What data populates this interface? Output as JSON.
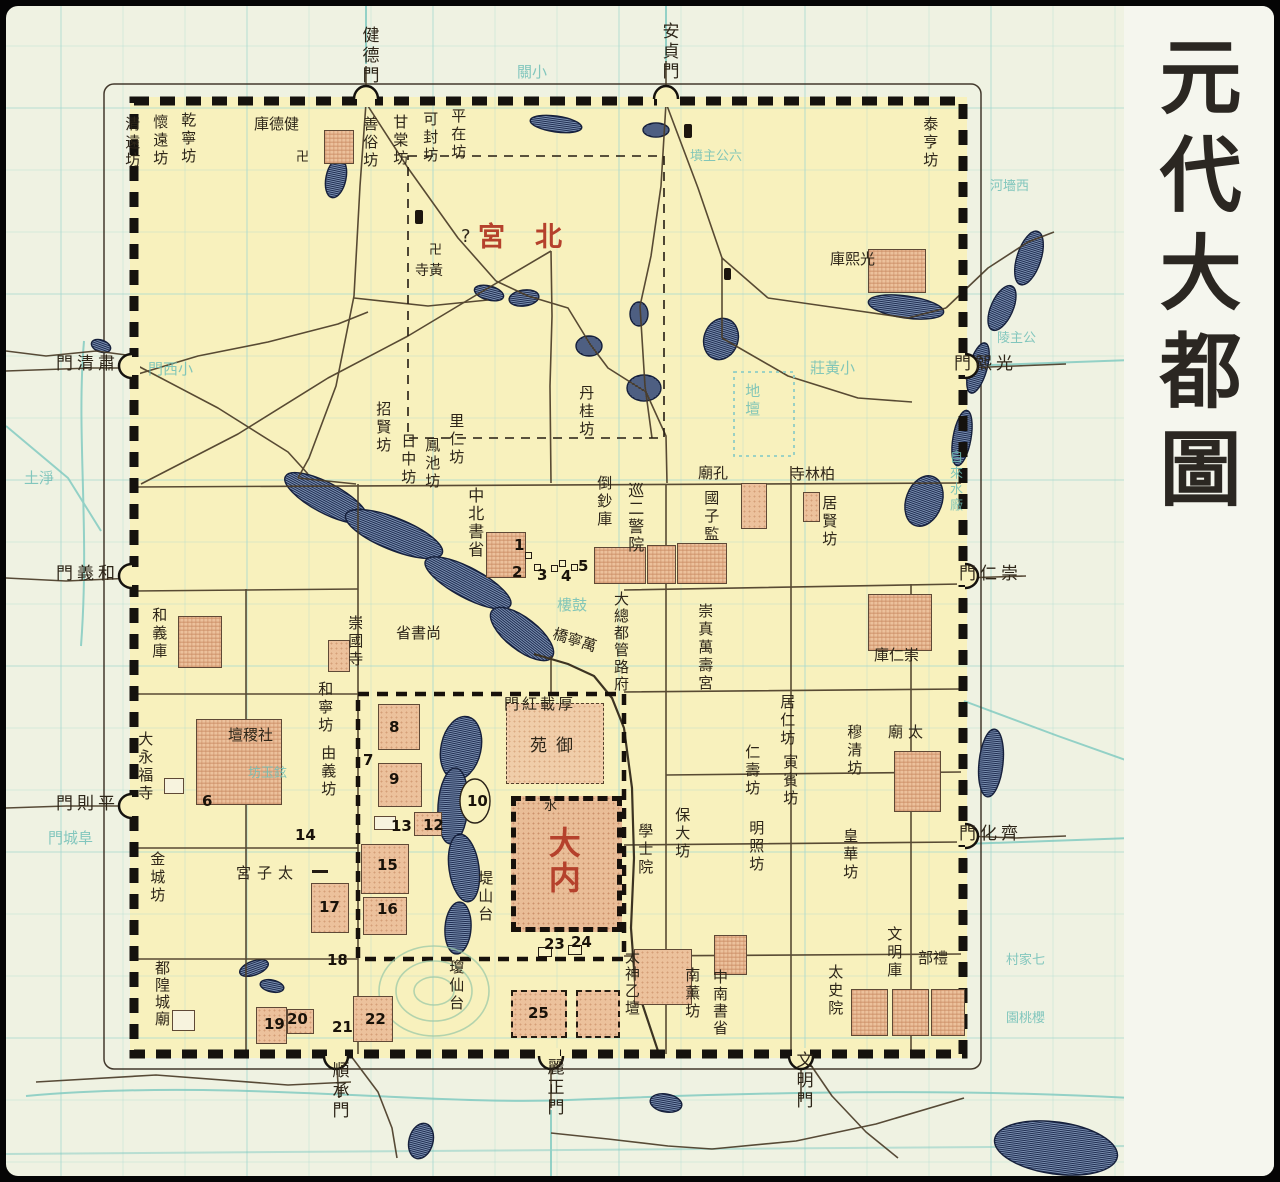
{
  "title": {
    "text": "元代大都圖"
  },
  "colors": {
    "ink": "#2e2619",
    "red": "#b5412c",
    "cyan": "#6fbfb7",
    "city_fill": "#f8f1bd",
    "paper": "#eff2e2",
    "building": "#ecc19c",
    "water_stripe": "#1e2c50"
  },
  "labels": [
    {
      "id": "gate-jiande",
      "t": "健德門",
      "x": 352,
      "y": 20,
      "d": "v",
      "s": 17
    },
    {
      "id": "gate-anzhen",
      "t": "安貞門",
      "x": 652,
      "y": 16,
      "d": "v",
      "s": 17
    },
    {
      "id": "gate-suqing",
      "t": "門清肅",
      "x": 50,
      "y": 349,
      "d": "h",
      "s": 17,
      "ls": 4
    },
    {
      "id": "gate-heyi",
      "t": "門義和",
      "x": 50,
      "y": 559,
      "d": "h",
      "s": 17,
      "ls": 4
    },
    {
      "id": "gate-pingze",
      "t": "門則平",
      "x": 50,
      "y": 789,
      "d": "h",
      "s": 17,
      "ls": 4
    },
    {
      "id": "gate-guangxi",
      "t": "門熙光",
      "x": 948,
      "y": 349,
      "d": "h",
      "s": 17,
      "ls": 4
    },
    {
      "id": "gate-chongren",
      "t": "門仁崇",
      "x": 953,
      "y": 559,
      "d": "h",
      "s": 17,
      "ls": 4
    },
    {
      "id": "gate-qihua",
      "t": "門化齊",
      "x": 953,
      "y": 819,
      "d": "h",
      "s": 17,
      "ls": 4
    },
    {
      "id": "gate-shuncheng",
      "t": "順承門",
      "x": 322,
      "y": 1055,
      "d": "v",
      "s": 17
    },
    {
      "id": "gate-lizheng",
      "t": "麗正門",
      "x": 537,
      "y": 1052,
      "d": "v",
      "s": 17
    },
    {
      "id": "gate-wenming",
      "t": "文明門",
      "x": 786,
      "y": 1045,
      "d": "v",
      "s": 17
    },
    {
      "id": "beigong",
      "t": "宮北",
      "x": 472,
      "y": 216,
      "d": "h",
      "s": 27,
      "c": "r",
      "ls": 30
    },
    {
      "id": "beigong-question",
      "t": "?",
      "x": 455,
      "y": 221,
      "d": "h",
      "s": 18
    },
    {
      "id": "danei",
      "t": "大内",
      "x": 538,
      "y": 820,
      "d": "v",
      "s": 32,
      "c": "r"
    },
    {
      "id": "fang-qingyuan",
      "t": "清遠坊",
      "x": 117,
      "y": 110
    },
    {
      "id": "fang-huaiyuan",
      "t": "懷遠坊",
      "x": 145,
      "y": 108
    },
    {
      "id": "fang-qianning",
      "t": "乾寧坊",
      "x": 173,
      "y": 106
    },
    {
      "id": "jiande-ku",
      "t": "庫德健",
      "x": 248,
      "y": 110,
      "d": "h"
    },
    {
      "id": "swastika-jiande",
      "t": "卍",
      "x": 290,
      "y": 145,
      "d": "h",
      "s": 13
    },
    {
      "id": "fang-shansu",
      "t": "善俗坊",
      "x": 355,
      "y": 110
    },
    {
      "id": "fang-gantang",
      "t": "甘棠坊",
      "x": 385,
      "y": 108
    },
    {
      "id": "fang-kefeng",
      "t": "可封坊",
      "x": 415,
      "y": 105
    },
    {
      "id": "fang-pingzai",
      "t": "平在坊",
      "x": 443,
      "y": 102
    },
    {
      "id": "fang-taiheng",
      "t": "泰亨坊",
      "x": 915,
      "y": 110
    },
    {
      "id": "guangxi-ku",
      "t": "庫熙光",
      "x": 824,
      "y": 245,
      "d": "h"
    },
    {
      "id": "swastika-huangsi",
      "t": "卍",
      "x": 423,
      "y": 238,
      "d": "h",
      "s": 13
    },
    {
      "id": "huang-si",
      "t": "寺黃",
      "x": 409,
      "y": 257,
      "d": "h",
      "s": 14
    },
    {
      "id": "fang-dangui",
      "t": "丹桂坊",
      "x": 571,
      "y": 379
    },
    {
      "id": "fang-zhaoxian",
      "t": "招賢坊",
      "x": 368,
      "y": 395
    },
    {
      "id": "fang-rizhong",
      "t": "日中坊",
      "x": 393,
      "y": 427
    },
    {
      "id": "fang-fengchi",
      "t": "鳳池坊",
      "x": 417,
      "y": 431
    },
    {
      "id": "fang-liren",
      "t": "里仁坊",
      "x": 441,
      "y": 407
    },
    {
      "id": "zhongshu-beisheng",
      "t": "中北書省",
      "x": 459,
      "y": 481,
      "d": "g",
      "s": 16
    },
    {
      "id": "daochao-ku",
      "t": "倒鈔庫",
      "x": 589,
      "y": 469
    },
    {
      "id": "jingxun-yuan",
      "t": "巡二警院",
      "x": 619,
      "y": 476,
      "d": "g",
      "s": 16
    },
    {
      "id": "kong-miao",
      "t": "廟孔",
      "x": 692,
      "y": 459,
      "d": "h"
    },
    {
      "id": "guozijian",
      "t": "國子監",
      "x": 696,
      "y": 484
    },
    {
      "id": "bailin-si",
      "t": "寺林柏",
      "x": 784,
      "y": 460,
      "d": "h"
    },
    {
      "id": "fang-juxian",
      "t": "居賢坊",
      "x": 814,
      "y": 489
    },
    {
      "id": "chongren-ku",
      "t": "庫仁崇",
      "x": 868,
      "y": 641,
      "d": "h"
    },
    {
      "id": "chongzhen-wanshougong",
      "t": "崇真萬壽宮",
      "x": 690,
      "y": 597
    },
    {
      "id": "dadu-zongguanfu",
      "t": "大總都管路府",
      "x": 606,
      "y": 585,
      "d": "g",
      "s": 15
    },
    {
      "id": "shangshu-sheng",
      "t": "省書尚",
      "x": 390,
      "y": 619,
      "d": "h"
    },
    {
      "id": "chongguo-si",
      "t": "崇國寺",
      "x": 340,
      "y": 609
    },
    {
      "id": "fang-hening",
      "t": "和寧坊",
      "x": 310,
      "y": 675
    },
    {
      "id": "fang-youyi",
      "t": "由義坊",
      "x": 313,
      "y": 739
    },
    {
      "id": "sheji-tan",
      "t": "壇稷社",
      "x": 222,
      "y": 721,
      "d": "h"
    },
    {
      "id": "dayongfu-si",
      "t": "大永福寺",
      "x": 130,
      "y": 725
    },
    {
      "id": "fang-jincheng",
      "t": "金城坊",
      "x": 142,
      "y": 845
    },
    {
      "id": "taizi-gong",
      "t": "宮子太",
      "x": 230,
      "y": 859,
      "d": "h",
      "ls": 6
    },
    {
      "id": "ducheng-huangmiao",
      "t": "都隍城廟",
      "x": 147,
      "y": 954,
      "d": "g",
      "s": 15
    },
    {
      "id": "qiongxian-tai",
      "t": "瓊仙台",
      "x": 441,
      "y": 953
    },
    {
      "id": "dishan-tai",
      "t": "堤山台",
      "x": 470,
      "y": 864
    },
    {
      "id": "houzai-hongmen",
      "t": "門紅載厚",
      "x": 498,
      "y": 690,
      "d": "h",
      "ls": 3
    },
    {
      "id": "yu-yuan",
      "t": "苑御",
      "x": 524,
      "y": 731,
      "d": "h",
      "s": 17,
      "ls": 9
    },
    {
      "id": "xueshi-yuan",
      "t": "學士院",
      "x": 630,
      "y": 817
    },
    {
      "id": "fang-baoda",
      "t": "保大坊",
      "x": 667,
      "y": 801
    },
    {
      "id": "taiyi-shentan",
      "t": "太神乙壇",
      "x": 617,
      "y": 943,
      "d": "g",
      "s": 15
    },
    {
      "id": "fang-nanxun",
      "t": "南薰坊",
      "x": 677,
      "y": 961
    },
    {
      "id": "zhongshu-nansheng",
      "t": "中南書省",
      "x": 705,
      "y": 963,
      "d": "g",
      "s": 15
    },
    {
      "id": "taishi-yuan",
      "t": "太史院",
      "x": 820,
      "y": 958
    },
    {
      "id": "wenming-ku",
      "t": "文明庫",
      "x": 879,
      "y": 920
    },
    {
      "id": "li-bu",
      "t": "部禮",
      "x": 912,
      "y": 944,
      "d": "h"
    },
    {
      "id": "fang-mingzhao",
      "t": "明照坊",
      "x": 741,
      "y": 814
    },
    {
      "id": "fang-huanghua",
      "t": "皇華坊",
      "x": 835,
      "y": 822
    },
    {
      "id": "fang-muqing",
      "t": "穆清坊",
      "x": 839,
      "y": 718
    },
    {
      "id": "fang-juren",
      "t": "居仁坊",
      "x": 772,
      "y": 688
    },
    {
      "id": "fang-yinbin",
      "t": "寅賓坊",
      "x": 775,
      "y": 748
    },
    {
      "id": "fang-renshou",
      "t": "仁壽坊",
      "x": 737,
      "y": 738
    },
    {
      "id": "tai-miao",
      "t": "廟太",
      "x": 882,
      "y": 718,
      "d": "h",
      "ls": 5
    },
    {
      "id": "heyi-ku",
      "t": "和義庫",
      "x": 144,
      "y": 601
    },
    {
      "id": "wanning-qiao",
      "t": "橋寧萬",
      "x": 546,
      "y": 626,
      "d": "h",
      "r": 18
    },
    {
      "id": "shui-char",
      "t": "水",
      "x": 538,
      "y": 794,
      "d": "h",
      "s": 13
    },
    {
      "id": "bg-xiaoximen",
      "t": "門西小",
      "x": 142,
      "y": 355,
      "d": "h",
      "c": "c"
    },
    {
      "id": "bg-fuchengmen",
      "t": "門城阜",
      "x": 42,
      "y": 824,
      "d": "h",
      "c": "c"
    },
    {
      "id": "bg-gulou",
      "t": "樓鼓",
      "x": 551,
      "y": 591,
      "d": "h",
      "c": "c"
    },
    {
      "id": "bg-ditan",
      "t": "地壇",
      "x": 737,
      "y": 377,
      "d": "v",
      "c": "c"
    },
    {
      "id": "bg-xiaoguan",
      "t": "關小",
      "x": 511,
      "y": 58,
      "d": "h",
      "c": "c"
    },
    {
      "id": "bg-liugongzhufen",
      "t": "墳主公六",
      "x": 684,
      "y": 144,
      "d": "h",
      "c": "c",
      "s": 13
    },
    {
      "id": "bg-gongzhuling",
      "t": "陵主公",
      "x": 991,
      "y": 326,
      "d": "h",
      "c": "c",
      "s": 13
    },
    {
      "id": "bg-xiaohuangzhuang",
      "t": "莊黃小",
      "x": 804,
      "y": 354,
      "d": "h",
      "c": "c"
    },
    {
      "id": "bg-xiheqiang",
      "t": "河墻西",
      "x": 984,
      "y": 174,
      "d": "h",
      "c": "c",
      "s": 13
    },
    {
      "id": "bg-jingtu",
      "t": "土淨",
      "x": 18,
      "y": 464,
      "d": "h",
      "c": "c"
    },
    {
      "id": "bg-yuxuanfang",
      "t": "坊玉鉉",
      "x": 242,
      "y": 761,
      "d": "h",
      "c": "c",
      "s": 13
    },
    {
      "id": "bg-zilaishuichang",
      "t": "自來水廠",
      "x": 940,
      "y": 444,
      "d": "v",
      "c": "c",
      "s": 13
    },
    {
      "id": "bg-yingtaoyuan",
      "t": "園桃櫻",
      "x": 1000,
      "y": 1006,
      "d": "h",
      "c": "c",
      "s": 13
    },
    {
      "id": "bg-qijiacun",
      "t": "村家七",
      "x": 1000,
      "y": 948,
      "d": "h",
      "c": "c",
      "s": 13
    }
  ],
  "numbers": [
    [
      1,
      508,
      530
    ],
    [
      2,
      506,
      557
    ],
    [
      3,
      531,
      560
    ],
    [
      4,
      555,
      561
    ],
    [
      5,
      572,
      551
    ],
    [
      6,
      196,
      786
    ],
    [
      7,
      357,
      745
    ],
    [
      8,
      383,
      712
    ],
    [
      9,
      383,
      764
    ],
    [
      10,
      461,
      786
    ],
    [
      12,
      417,
      810
    ],
    [
      13,
      385,
      811
    ],
    [
      14,
      289,
      820
    ],
    [
      15,
      371,
      850
    ],
    [
      16,
      371,
      894
    ],
    [
      17,
      313,
      892
    ],
    [
      18,
      321,
      945
    ],
    [
      19,
      258,
      1009
    ],
    [
      20,
      281,
      1004
    ],
    [
      21,
      326,
      1012
    ],
    [
      22,
      359,
      1004
    ],
    [
      23,
      538,
      929
    ],
    [
      24,
      565,
      927
    ],
    [
      25,
      522,
      998
    ]
  ],
  "buildings": [
    [
      318,
      124,
      30,
      34,
      "s"
    ],
    [
      862,
      243,
      58,
      44,
      "s"
    ],
    [
      480,
      526,
      40,
      46,
      "s"
    ],
    [
      588,
      541,
      52,
      37,
      "s"
    ],
    [
      641,
      539,
      29,
      39,
      "s"
    ],
    [
      671,
      537,
      50,
      41,
      "s"
    ],
    [
      172,
      610,
      44,
      52,
      "s"
    ],
    [
      190,
      713,
      86,
      86,
      "s"
    ],
    [
      322,
      634,
      22,
      32,
      "p"
    ],
    [
      735,
      477,
      26,
      46,
      "p"
    ],
    [
      797,
      486,
      17,
      30,
      "p"
    ],
    [
      862,
      588,
      64,
      57,
      "s"
    ],
    [
      372,
      698,
      42,
      46,
      "p"
    ],
    [
      372,
      757,
      44,
      44,
      "p"
    ],
    [
      408,
      806,
      28,
      24,
      "p"
    ],
    [
      355,
      838,
      48,
      50,
      "p"
    ],
    [
      357,
      891,
      44,
      38,
      "p"
    ],
    [
      305,
      877,
      38,
      50,
      "p"
    ],
    [
      250,
      1001,
      31,
      37,
      "p"
    ],
    [
      281,
      1003,
      27,
      25,
      "p"
    ],
    [
      347,
      990,
      40,
      46,
      "p"
    ],
    [
      628,
      943,
      58,
      56,
      "p"
    ],
    [
      708,
      929,
      33,
      40,
      "s"
    ],
    [
      845,
      983,
      37,
      47,
      "s"
    ],
    [
      886,
      983,
      37,
      47,
      "s"
    ],
    [
      925,
      983,
      34,
      47,
      "s"
    ],
    [
      505,
      984,
      56,
      48,
      "d"
    ],
    [
      570,
      984,
      44,
      48,
      "d"
    ],
    [
      888,
      745,
      47,
      61,
      "s"
    ],
    [
      166,
      1004,
      23,
      21,
      "w"
    ],
    [
      500,
      697,
      98,
      81,
      "yy"
    ],
    [
      505,
      790,
      111,
      136,
      "dn"
    ],
    [
      158,
      772,
      20,
      16,
      "w"
    ],
    [
      368,
      810,
      22,
      14,
      "w"
    ]
  ],
  "marks": [
    [
      519,
      546,
      7,
      7,
      "sq"
    ],
    [
      528,
      558,
      7,
      7,
      "sq"
    ],
    [
      545,
      559,
      7,
      7,
      "sq"
    ],
    [
      553,
      554,
      7,
      7,
      "sq"
    ],
    [
      565,
      558,
      7,
      7,
      "sq"
    ],
    [
      306,
      864,
      16,
      3,
      "dash"
    ],
    [
      532,
      941,
      14,
      10,
      "sq"
    ],
    [
      562,
      939,
      14,
      10,
      "sq"
    ],
    [
      409,
      204,
      8,
      14,
      "blk"
    ],
    [
      678,
      118,
      8,
      14,
      "blk"
    ],
    [
      718,
      262,
      7,
      12,
      "blk"
    ]
  ]
}
